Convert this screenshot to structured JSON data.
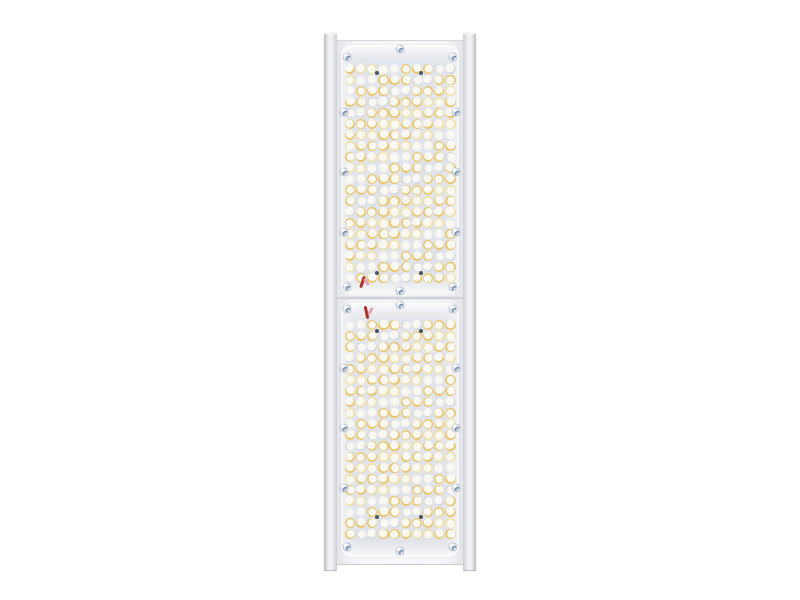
{
  "meta": {
    "description": "Product photo of a vertical linear LED luminaire with two lens modules on a white background. No visible text.",
    "background_color": "#ffffff"
  },
  "fixture": {
    "rails": {
      "y": 33,
      "height": 538,
      "width": 13,
      "left_x": 324,
      "right_x": 463,
      "color": "#e9ebee",
      "edge_color": "#b9bcc2"
    },
    "body": {
      "x": 337,
      "y": 40,
      "width": 126,
      "height": 523,
      "color": "#f5f6f8"
    },
    "seam": {
      "x": 337,
      "y": 296,
      "width": 126,
      "height": 4
    },
    "modules": [
      {
        "name": "led-module-top",
        "plate": {
          "x": 341,
          "y": 45,
          "width": 118,
          "height": 249
        },
        "grid": {
          "cols": 10,
          "rows": 20,
          "x0": 350,
          "y0": 69,
          "pitch_x": 11.15,
          "pitch_y": 11.0,
          "diameter": 10.4
        },
        "dots": [
          [
            377,
            73
          ],
          [
            421,
            73
          ],
          [
            377,
            273
          ],
          [
            421,
            273
          ]
        ],
        "wires": [
          {
            "x": 361,
            "y": 276,
            "w": 2.5,
            "h": 12,
            "rot": 18,
            "color": "#a93226"
          },
          {
            "x": 365,
            "y": 278,
            "w": 2.5,
            "h": 8,
            "rot": -35,
            "color": "#e8a0b4"
          }
        ]
      },
      {
        "name": "led-module-bottom",
        "plate": {
          "x": 341,
          "y": 303,
          "width": 118,
          "height": 254
        },
        "grid": {
          "cols": 10,
          "rows": 20,
          "x0": 350,
          "y0": 325,
          "pitch_x": 11.15,
          "pitch_y": 11.0,
          "diameter": 10.4
        },
        "dots": [
          [
            377,
            331
          ],
          [
            421,
            331
          ],
          [
            377,
            517
          ],
          [
            421,
            517
          ]
        ],
        "wires": [
          {
            "x": 365,
            "y": 306,
            "w": 2.5,
            "h": 13,
            "rot": -12,
            "color": "#a93226"
          },
          {
            "x": 369,
            "y": 307,
            "w": 2.5,
            "h": 8,
            "rot": 30,
            "color": "#e8a0b4"
          }
        ]
      }
    ],
    "screws": {
      "size": 8,
      "positions": [
        [
          347,
          57
        ],
        [
          400,
          49
        ],
        [
          453,
          57
        ],
        [
          344,
          112
        ],
        [
          456,
          112
        ],
        [
          344,
          172
        ],
        [
          456,
          172
        ],
        [
          344,
          232
        ],
        [
          456,
          232
        ],
        [
          347,
          287
        ],
        [
          400,
          291
        ],
        [
          453,
          287
        ],
        [
          347,
          309
        ],
        [
          400,
          305
        ],
        [
          453,
          309
        ],
        [
          344,
          368
        ],
        [
          456,
          368
        ],
        [
          344,
          428
        ],
        [
          456,
          428
        ],
        [
          344,
          488
        ],
        [
          456,
          488
        ],
        [
          347,
          547
        ],
        [
          400,
          551
        ],
        [
          453,
          547
        ]
      ]
    },
    "dot_size": 3.5,
    "led_colors": {
      "face": "#faf8f3",
      "rim": "#dde0e5",
      "rings": {
        "amber": "#eac463",
        "pale": "#f2dfa0",
        "gray": "#d6dae0",
        "light": "#e8eaee"
      }
    }
  }
}
